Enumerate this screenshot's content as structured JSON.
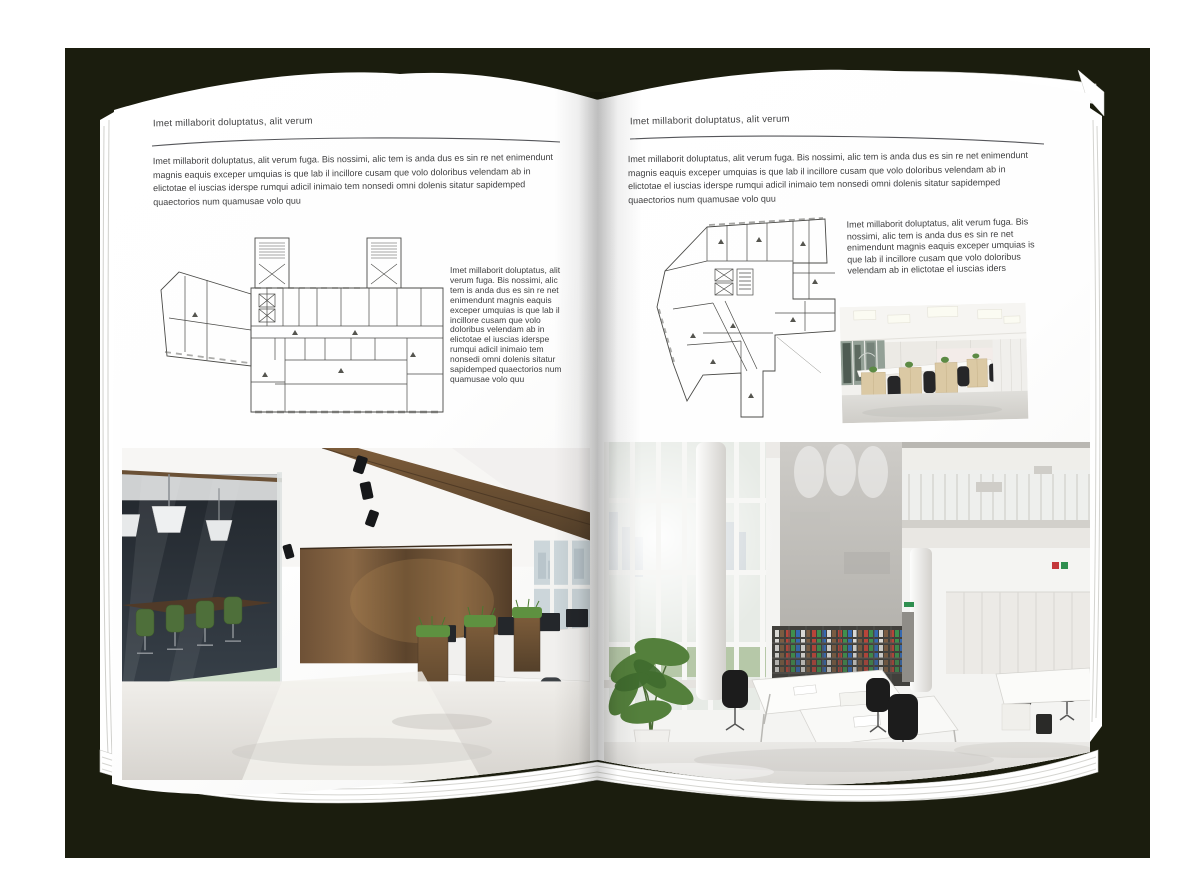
{
  "page_left": {
    "header": "Imet millaborit doluptatus, alit verum",
    "intro": "Imet millaborit doluptatus, alit verum fuga. Bis nossimi, alic tem is anda dus es sin re net enimendunt magnis eaquis exceper umquias is que lab il incillore cusam que volo doloribus velendam ab in elictotae el iuscias iderspe rumqui adicil inimaio tem nonsedi omni dolenis sitatur sapidemped quaectorios num quamusae volo quu",
    "caption": "Imet millaborit doluptatus, alit verum fuga. Bis nossimi, alic tem is anda dus es sin re net enimendunt magnis eaquis exceper umquias is que lab il incillore cusam que volo doloribus velendam ab in elictotae el iuscias iderspe rumqui adicil inimaio tem nonsedi omni dolenis sitatur sapidemped quaectorios num quamusae volo quu"
  },
  "page_right": {
    "header": "Imet millaborit doluptatus, alit verum",
    "intro": "Imet millaborit doluptatus, alit verum fuga. Bis nossimi, alic tem is anda dus es sin re net enimendunt magnis eaquis exceper umquias is que lab il incillore cusam que volo doloribus velendam ab in elictotae el iuscias iderspe rumqui adicil inimaio tem nonsedi omni dolenis sitatur sapidemped quaectorios num quamusae volo quu",
    "caption": "Imet millaborit doluptatus, alit verum fuga. Bis nossimi, alic tem is anda dus es sin re net enimendunt magnis eaquis exceper umquias is que lab il incillore cusam que volo doloribus velendam ab in elictotae el iuscias iders"
  },
  "colors": {
    "backdrop": "#1b1d0e",
    "page": "#ffffff",
    "body_text": "#3f3f40",
    "rule_line": "#55565a",
    "plan_line": "#4b4b48"
  }
}
